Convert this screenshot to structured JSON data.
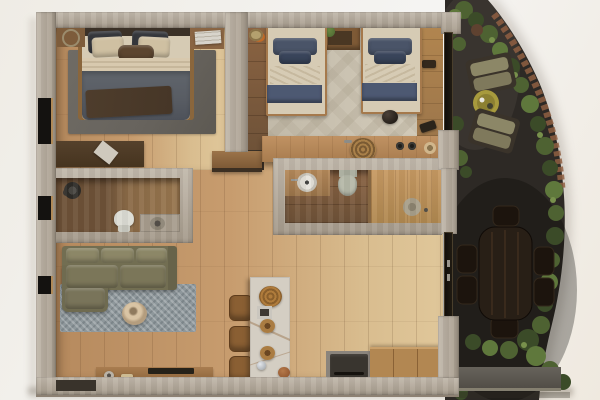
{
  "meta": {
    "title": "Top-down 3D render of a two-bedroom apartment floor plan with a curved side garden patio"
  },
  "palette": {
    "bg1": "#efece5",
    "bg2": "#f5f4f2",
    "wallHi": "#c2b9ac",
    "wallLo": "#a69b8c",
    "woodWarm": "#b68a5e",
    "woodPale": "#d9bd8f",
    "woodMid": "#a87c4e",
    "woodDark": "#6e5238",
    "tileLight": "#cdc5b4",
    "rugGray": "#67635d",
    "rugBlue": "#8e979b",
    "sofa": "#726e52",
    "sofaHi": "#8c8767",
    "cream": "#d6cbb4",
    "navy": "#4a5468",
    "navyDark": "#39445a",
    "slate": "#585c63",
    "throw": "#463627",
    "marble": "#d4cec3",
    "stove": "#39352f",
    "charcoal": "#2d2925",
    "foliage1": "#3b4b28",
    "foliage2": "#4e6232",
    "foliage3": "#5f783c",
    "foliage4": "#78914c",
    "brick": "#8f5f42",
    "gold": "#a79a3d",
    "tableDark": "#281f16",
    "chairDark": "#1c140d",
    "stoneHi": "#67635b",
    "stoneLo": "#4e4a44"
  },
  "rooms": [
    {
      "name": "primary-bedroom",
      "items": [
        "double-bed",
        "gray-area-rug",
        "left-wall-shelf",
        "bedside-shelf",
        "writing-desk"
      ]
    },
    {
      "name": "twin-bedroom",
      "items": [
        "single-bed-left",
        "single-bed-right",
        "shared-nightstand-with-plant",
        "wardrobe-strip",
        "floor-bowl"
      ]
    },
    {
      "name": "bathroom-one",
      "items": [
        "rain-shower",
        "toilet",
        "round-basin-counter"
      ]
    },
    {
      "name": "bathroom-two",
      "items": [
        "round-sink",
        "toilet",
        "wood-deck-shower"
      ]
    },
    {
      "name": "kitchen",
      "items": [
        "counter-with-sink-and-burners",
        "marble-island",
        "three-stools",
        "stove",
        "cabinets"
      ]
    },
    {
      "name": "living-room",
      "items": [
        "l-shaped-olive-sofa",
        "woven-blue-rug",
        "round-pouf",
        "media-console",
        "entry-mat"
      ]
    },
    {
      "name": "garden-patio",
      "items": [
        "lounge-chair-upper",
        "lounge-chair-lower",
        "gold-side-table",
        "dining-table-six-chairs",
        "hedge-border",
        "brick-edge",
        "stone-ledge"
      ]
    }
  ]
}
